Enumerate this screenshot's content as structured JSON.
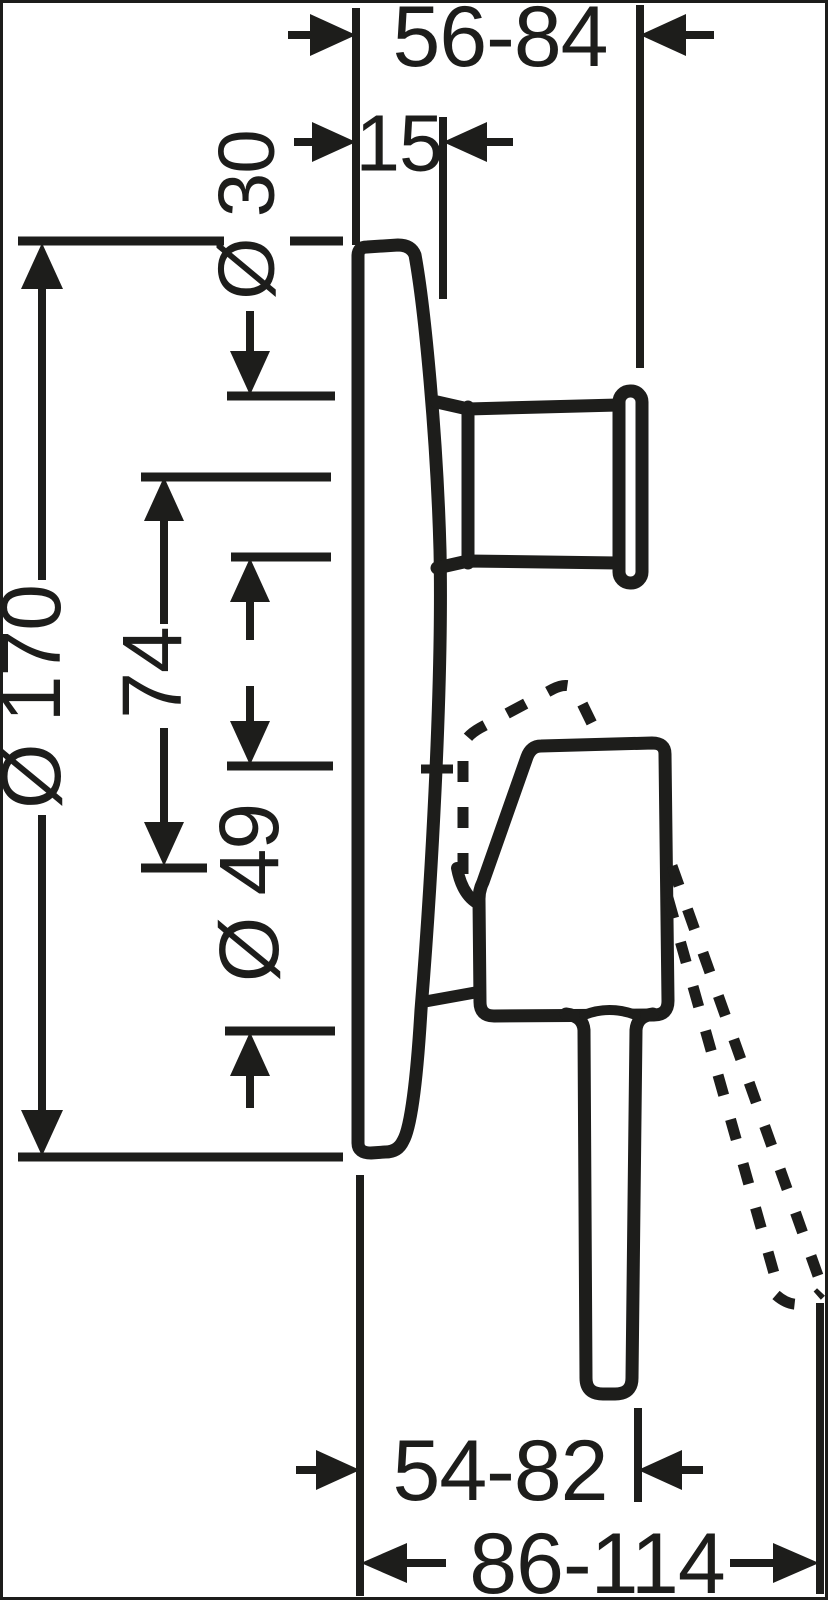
{
  "drawing": {
    "type": "technical-dimension-drawing",
    "background": "#ffffff",
    "line_color": "#1d1d1b",
    "dims": {
      "top_outer": "56-84",
      "top_inner": "15",
      "dia30": "Ø 30",
      "dia170": "Ø 170",
      "len74": "74",
      "dia49": "Ø 49",
      "bottom_inner": "54-82",
      "bottom_outer": "86-114"
    }
  }
}
